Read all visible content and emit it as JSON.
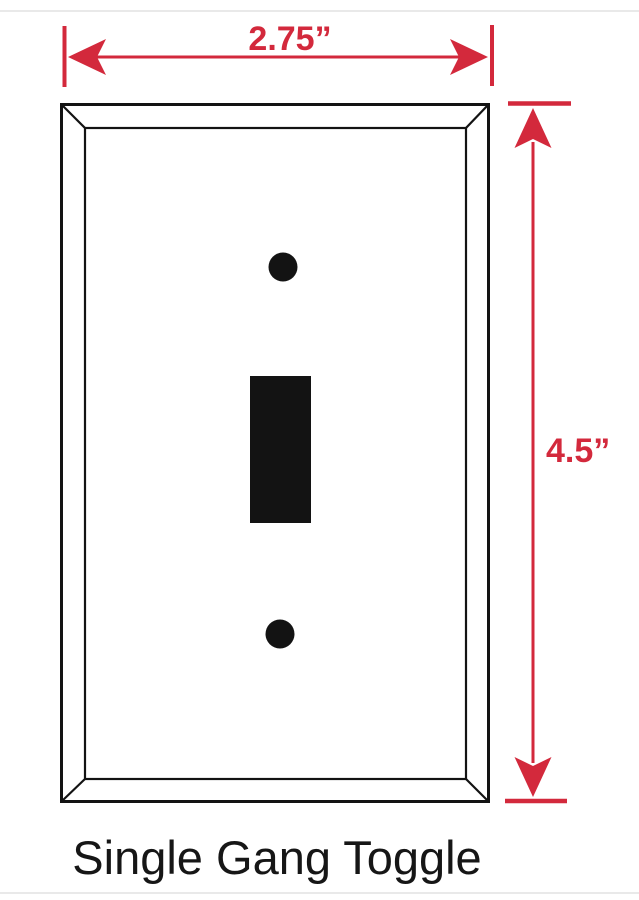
{
  "diagram": {
    "title": "Single Gang Toggle",
    "width_label": "2.75”",
    "height_label": "4.5”"
  },
  "colors": {
    "dimension_red": "#d3293c",
    "line_black": "#131313",
    "rule_gray": "#e9e9e9"
  }
}
